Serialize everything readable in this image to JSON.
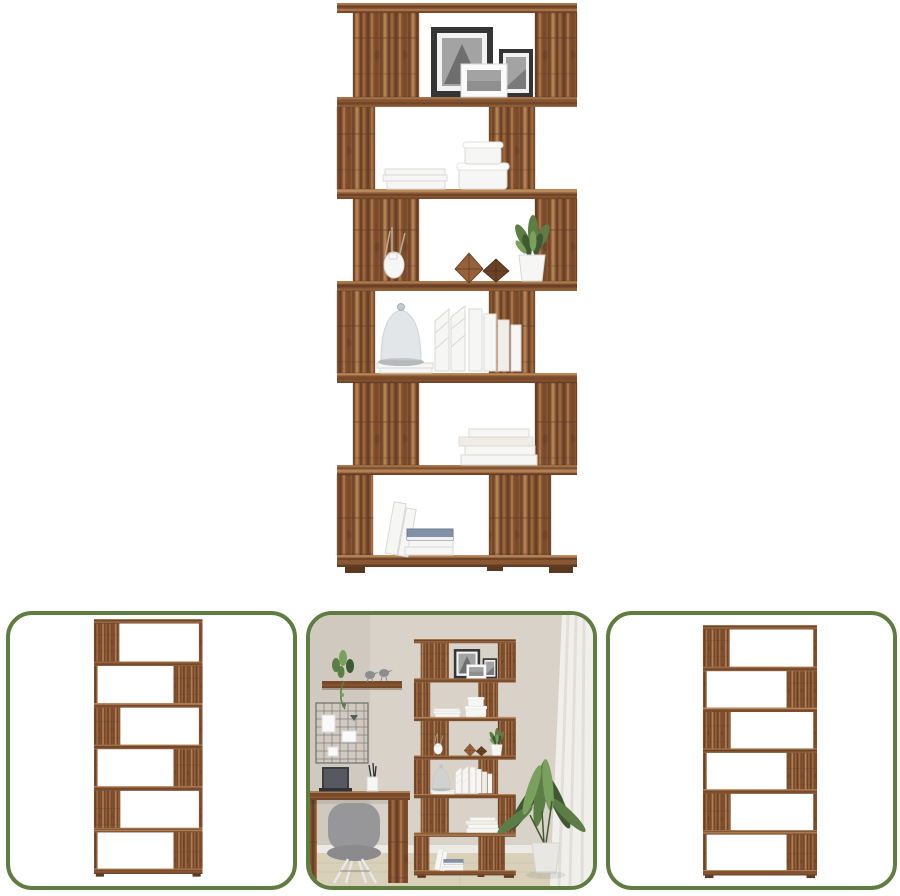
{
  "page": {
    "background": "#ffffff"
  },
  "main_image": {
    "label": "six-tier s-shaped room divider bookcase in aged wood decorated with picture frames, books, boxes and plants"
  },
  "thumbnails": [
    {
      "label": "empty bookcase angled view"
    },
    {
      "label": "bookcase in home office beside desk, chair and floor plant"
    },
    {
      "label": "empty bookcase front view"
    }
  ],
  "colors": {
    "thumb_border": "#5f7d40",
    "wood_base": "#8a5733",
    "wood_dark": "#5b3821",
    "wood_mid": "#7a4b2b",
    "wood_light": "#ab764a",
    "wood_pale": "#c89a66",
    "frame_dark": "#353535",
    "photo_gray": "#a3a3a3",
    "white_item": "#f6f6f4",
    "item_shadow": "#d9d8d4",
    "book_blue": "#8290a8",
    "glass_gray": "#ccd2d6",
    "plant_green": "#5c7d45",
    "plant_green_dark": "#3f5a32",
    "plant_green_light": "#79a05c",
    "wall": "#d9d2c8",
    "floor": "#d8d0b9",
    "curtain": "#f1efeb",
    "baseboard": "#eceae5",
    "chair_gray": "#97979a",
    "laptop_dark": "#3a3d42",
    "grid_dark": "#6f6d6a"
  }
}
